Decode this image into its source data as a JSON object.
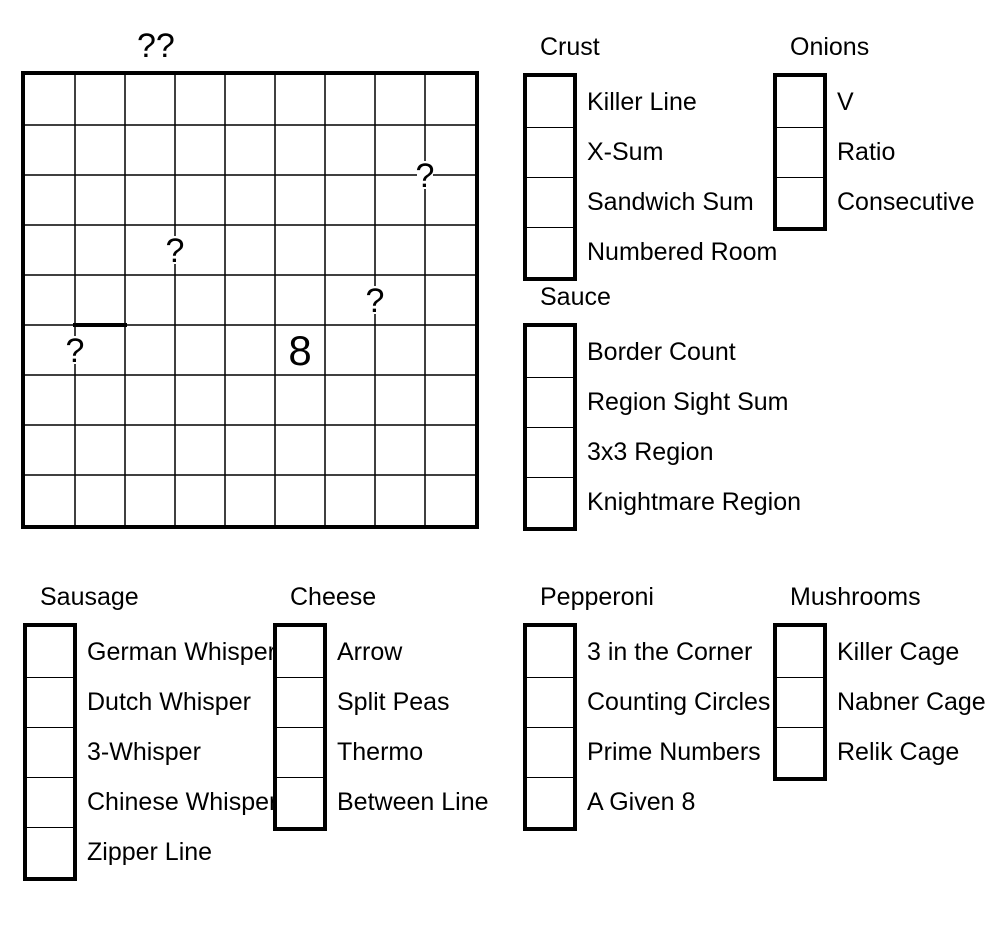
{
  "page": {
    "background_color": "#ffffff",
    "ink_color": "#000000"
  },
  "puzzle_grid": {
    "title": "??",
    "rows": 9,
    "cols": 9,
    "cell_px": 50,
    "givens": [
      {
        "row": 6,
        "col": 6,
        "value": "8"
      }
    ],
    "question_marks": [
      {
        "glyph": "?",
        "gx": 8,
        "gy": 2,
        "position": "corner between r2c8/r2c9 and r3c8/r3c9"
      },
      {
        "glyph": "?",
        "gx": 3,
        "gy": 3.5,
        "position": "edge between r4c3 and r4c4"
      },
      {
        "glyph": "?",
        "gx": 7,
        "gy": 4.5,
        "position": "edge between r5c7 and r5c8"
      },
      {
        "glyph": "?",
        "gx": 1,
        "gy": 5.5,
        "position": "edge between r6c1 and r6c2"
      }
    ],
    "thick_edge_segments": [
      {
        "gx1": 1,
        "gy1": 5,
        "gx2": 2,
        "gy2": 5,
        "position": "top edge of r6c2"
      }
    ]
  },
  "checkbox_state": "all-empty",
  "groups": [
    {
      "id": "crust",
      "title": "Crust",
      "items": [
        "Killer Line",
        "X-Sum",
        "Sandwich Sum",
        "Numbered Room"
      ]
    },
    {
      "id": "onions",
      "title": "Onions",
      "items": [
        "V",
        "Ratio",
        "Consecutive"
      ]
    },
    {
      "id": "sauce",
      "title": "Sauce",
      "items": [
        "Border Count",
        "Region Sight Sum",
        "3x3 Region",
        "Knightmare Region"
      ]
    },
    {
      "id": "sausage",
      "title": "Sausage",
      "items": [
        "German Whisper",
        "Dutch Whisper",
        "3-Whisper",
        "Chinese Whisper",
        "Zipper Line"
      ]
    },
    {
      "id": "cheese",
      "title": "Cheese",
      "items": [
        "Arrow",
        "Split Peas",
        "Thermo",
        "Between Line"
      ]
    },
    {
      "id": "pepperoni",
      "title": "Pepperoni",
      "items": [
        "3 in the Corner",
        "Counting Circles",
        "Prime Numbers",
        "A Given 8"
      ]
    },
    {
      "id": "mushrooms",
      "title": "Mushrooms",
      "items": [
        "Killer Cage",
        "Nabner Cage",
        "Relik Cage"
      ]
    }
  ]
}
